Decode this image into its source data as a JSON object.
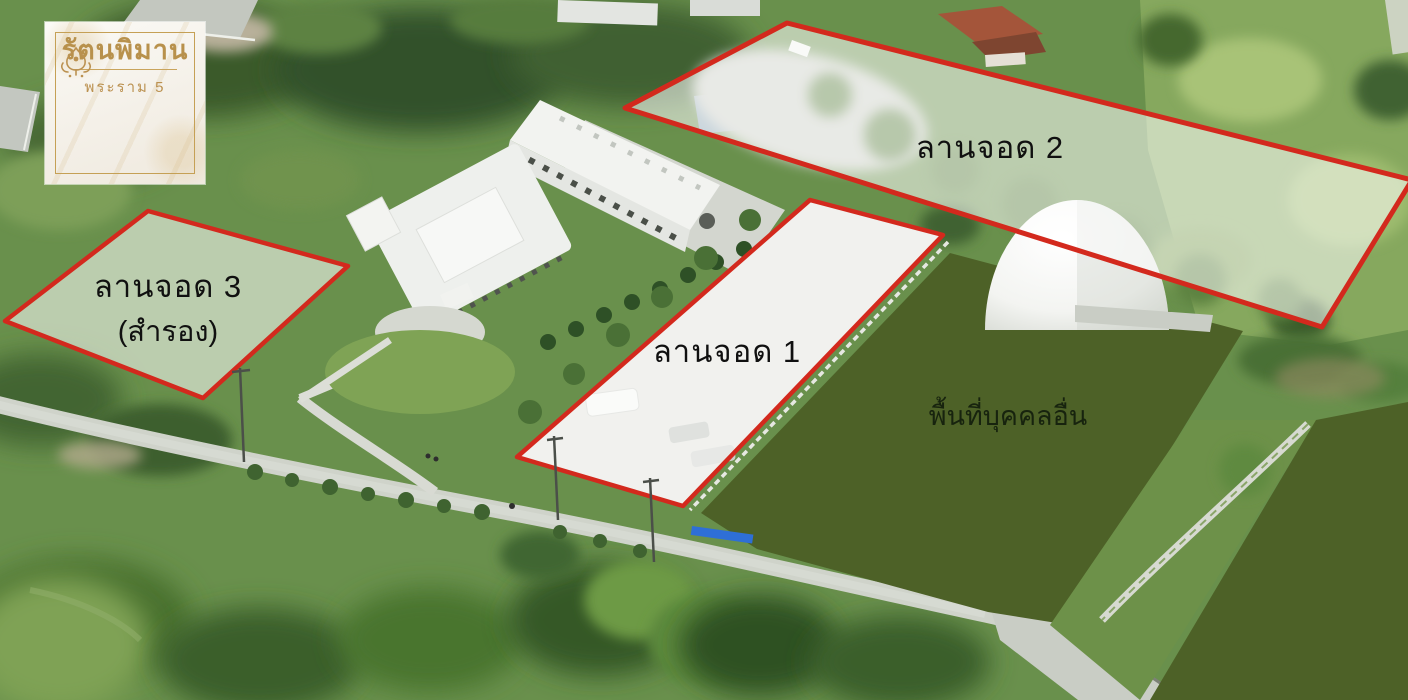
{
  "logo": {
    "title": "รัตนพิมาน",
    "subtitle": "พระราม 5",
    "gold": "#bb9150",
    "background": "#f8f5ef"
  },
  "zones": {
    "parking2": {
      "label": "ลานจอด 2",
      "points": "787,23 1412,180 1322,327 625,108",
      "label_x": "990",
      "label_y": "158"
    },
    "parking1": {
      "label": "ลานจอด 1",
      "points": "810,200 943,235 683,506 517,457",
      "label_x": "727",
      "label_y": "362"
    },
    "parking3": {
      "label": "ลานจอด 3",
      "sublabel": "(สำรอง)",
      "points": "148,211 348,266 203,398 5,321",
      "label_x": "168",
      "label_y": "297",
      "sublabel_x": "168",
      "sublabel_y": "341"
    },
    "other_area": {
      "label": "พื้นที่บุคคลอื่น",
      "points_main": "950,253 1243,331 1063,624 988,612 757,549 701,513",
      "points_right": "1316,420 1408,402 1408,700 1150,700",
      "label_x": "1008",
      "label_y": "425"
    }
  },
  "style": {
    "outline_color": "#d3291d",
    "zone_fill": "rgba(255,255,255,0.55)",
    "masked_fill": "#4d6127",
    "zone_label_color": "#101010",
    "other_label_color": "#17230e"
  }
}
